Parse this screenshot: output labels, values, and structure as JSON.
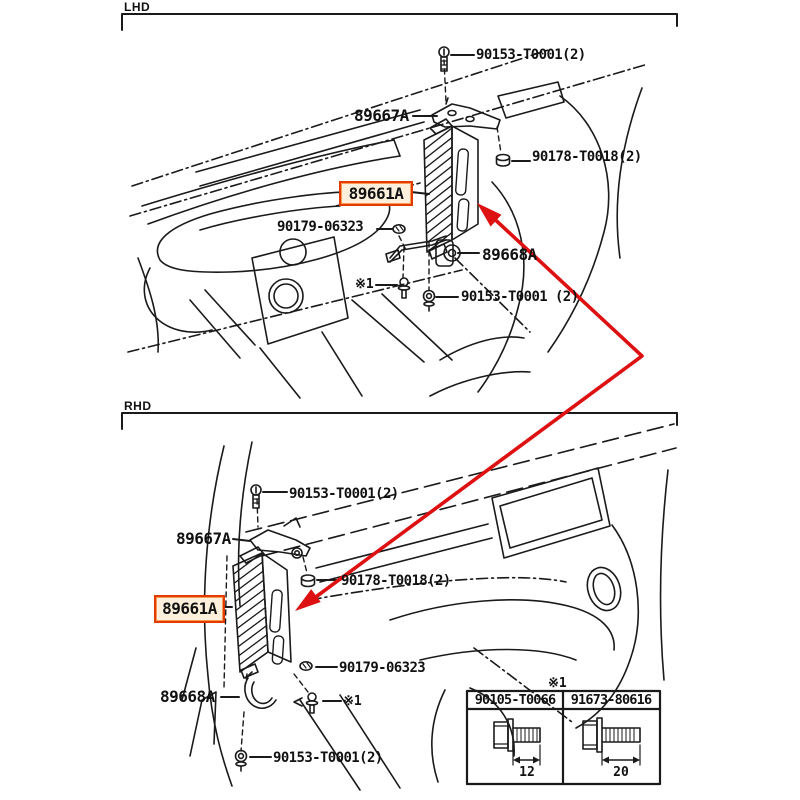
{
  "diagram": {
    "sections": {
      "lhd": {
        "label": "LHD",
        "callouts": {
          "screw_top": "90153-T0001(2)",
          "bracket_top": "89667A",
          "nut_side": "90178-T0018(2)",
          "ecu": "89661A",
          "bolt_washer": "90179-06323",
          "bracket_lower": "89668A",
          "ref": "※1",
          "screw_bottom": "90153-T0001 (2)"
        }
      },
      "rhd": {
        "label": "RHD",
        "callouts": {
          "screw_top": "90153-T0001(2)",
          "bracket_top": "89667A",
          "nut_side": "90178-T0018(2)",
          "ecu": "89661A",
          "bolt_washer": "90179-06323",
          "bracket_lower": "89668A",
          "ref": "※1",
          "screw_bottom": "90153-T0001(2)"
        }
      }
    },
    "legend": {
      "ref": "※1",
      "columns": [
        {
          "part_no": "90105-T0066",
          "length_mm": "12"
        },
        {
          "part_no": "91673-80616",
          "length_mm": "20"
        }
      ]
    },
    "highlight": {
      "part_no": "89661A",
      "border_color": "#e23b00",
      "fill_color": "#fcf0dd"
    },
    "colors": {
      "line": "#1a1a1a",
      "arrow_red": "#dd1111",
      "background": "#ffffff"
    }
  }
}
